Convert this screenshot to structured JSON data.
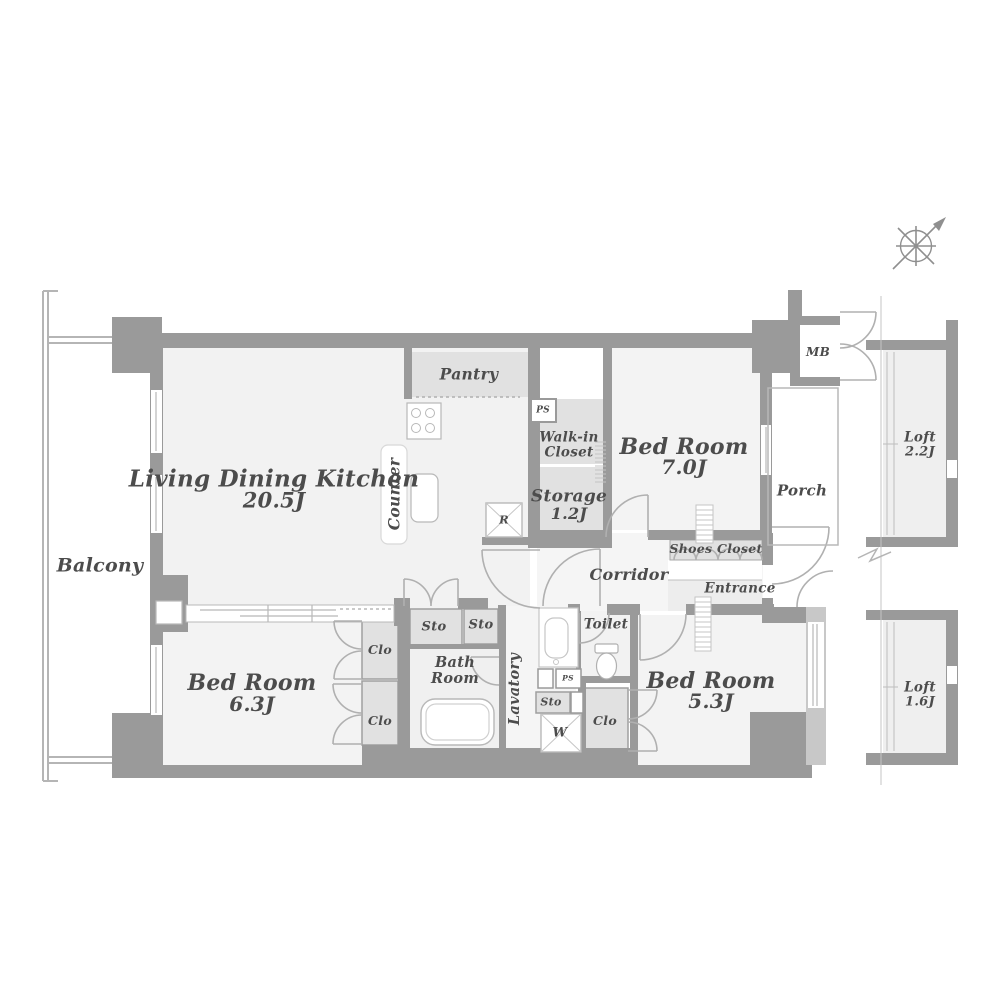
{
  "plan": {
    "balcony": "Balcony",
    "ldk": {
      "name": "Living Dining Kitchen",
      "area": "20.5J"
    },
    "kitchen": {
      "counter": "Counter",
      "refrigerator": "R",
      "pantry": "Pantry",
      "ps": "PS"
    },
    "walk_in_closet": {
      "line1": "Walk-in",
      "line2": "Closet"
    },
    "storage": {
      "name": "Storage",
      "area": "1.2J"
    },
    "bedroom_7": {
      "name": "Bed Room",
      "area": "7.0J"
    },
    "bedroom_63": {
      "name": "Bed Room",
      "area": "6.3J"
    },
    "bedroom_53": {
      "name": "Bed Room",
      "area": "5.3J"
    },
    "meter_box": "MB",
    "porch": "Porch",
    "shoes_closet": "Shoes Closet",
    "corridor": "Corridor",
    "entrance": "Entrance",
    "closets": {
      "clo_upper": "Clo",
      "clo_lower": "Clo",
      "clo_53": "Clo"
    },
    "storage_units": {
      "sto_left": "Sto",
      "sto_right": "Sto",
      "sto_small": "Sto"
    },
    "bath": {
      "line1": "Bath",
      "line2": "Room"
    },
    "lavatory": "Lavatory",
    "toilet": "Toilet",
    "utilities": {
      "ps_lower": "PS",
      "washer": "W"
    },
    "loft_upper": {
      "name": "Loft",
      "area": "2.2J"
    },
    "loft_lower": {
      "name": "Loft",
      "area": "1.6J"
    },
    "compass": {
      "icon": "compass-north-arrow"
    }
  },
  "colors": {
    "background": "#ffffff",
    "wall": "#9a9a9a",
    "light_wall": "#c8c8c8",
    "room_fill": "#f2f2f2",
    "closet_fill": "#e1e1e1",
    "line": "#b5b5b5",
    "text": "#4c4c4c"
  }
}
